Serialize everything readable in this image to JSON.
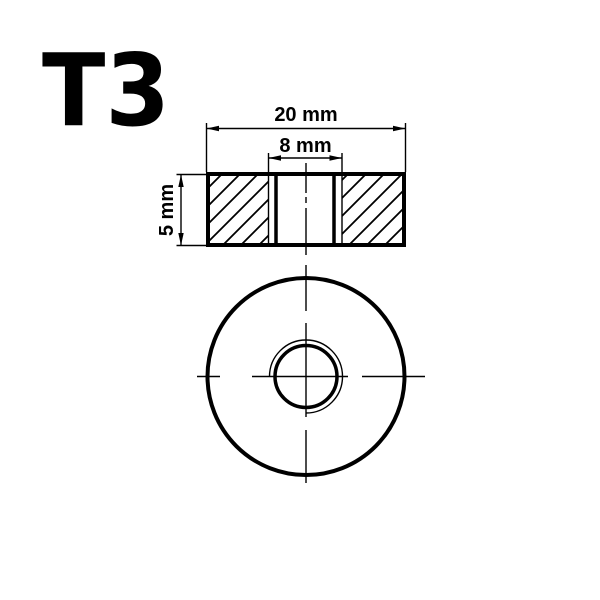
{
  "title": "T3",
  "section_view": {
    "outer_width_label": "20 mm",
    "hole_width_label": "8 mm",
    "thickness_label": "5 mm"
  },
  "part": {
    "outer_diameter_mm": 20,
    "hole_diameter_mm": 8,
    "thickness_mm": 5,
    "unit": "mm"
  },
  "colors": {
    "line": "#000000",
    "background": "#ffffff"
  }
}
